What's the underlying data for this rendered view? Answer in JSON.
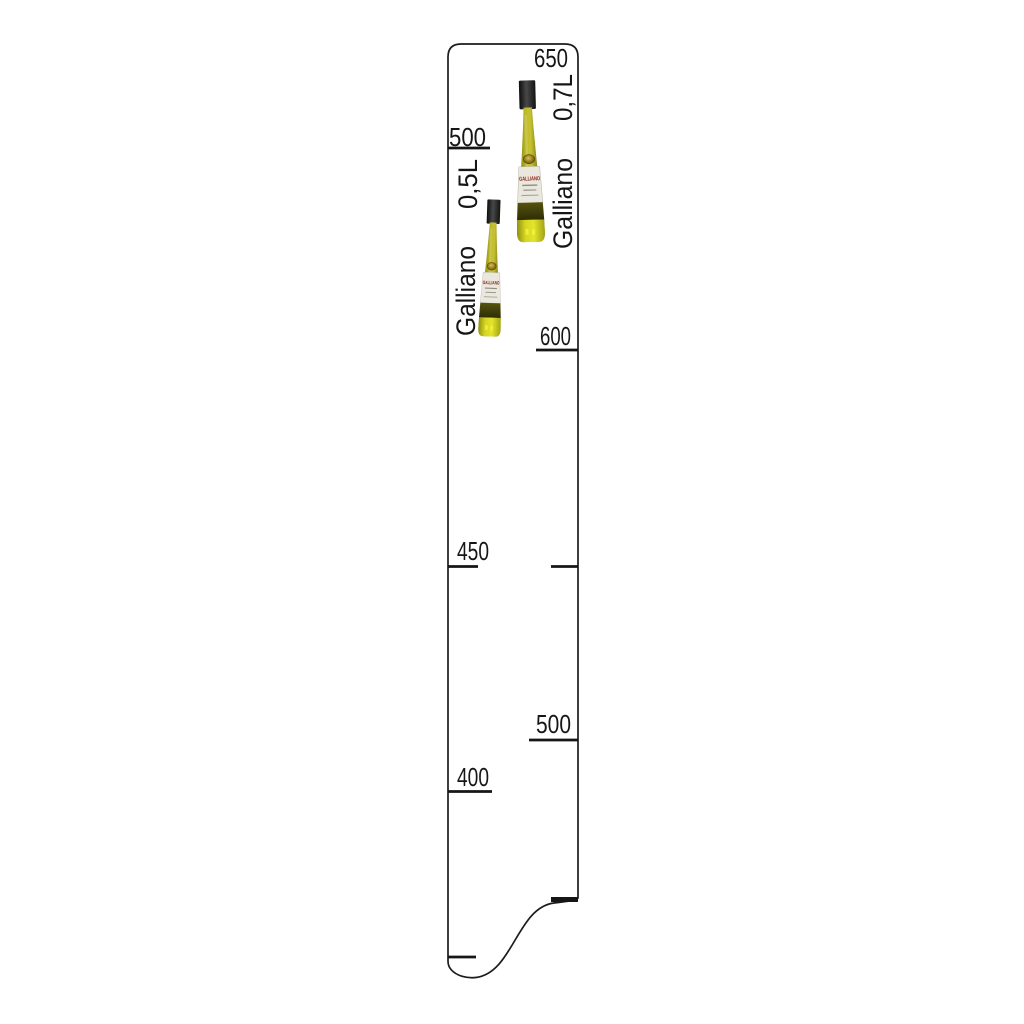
{
  "scene": {
    "description": "Bar measure ruler strip for Galliano bottles",
    "background": "#ffffff"
  },
  "ruler": {
    "outline_color": "#1c1c1c",
    "tick_color": "#161616",
    "fill": "#ffffff",
    "left_column": {
      "brand": "Galliano",
      "bottle_size": "0,5L",
      "marks": [
        {
          "label": "500"
        },
        {
          "label": "450"
        },
        {
          "label": "400"
        }
      ]
    },
    "right_column": {
      "brand": "Galliano",
      "bottle_size": "0,7L",
      "marks": [
        {
          "label": "650"
        },
        {
          "label": "600"
        },
        {
          "label": "500"
        }
      ]
    },
    "bottle": {
      "label_text": "GALLIANO",
      "liqueur_color": "#bdb92a",
      "base_glow_color": "#e4e42c",
      "cap_color": "#1b1b19",
      "label_background": "#e9e7de",
      "label_red": "#8a1d12"
    }
  }
}
